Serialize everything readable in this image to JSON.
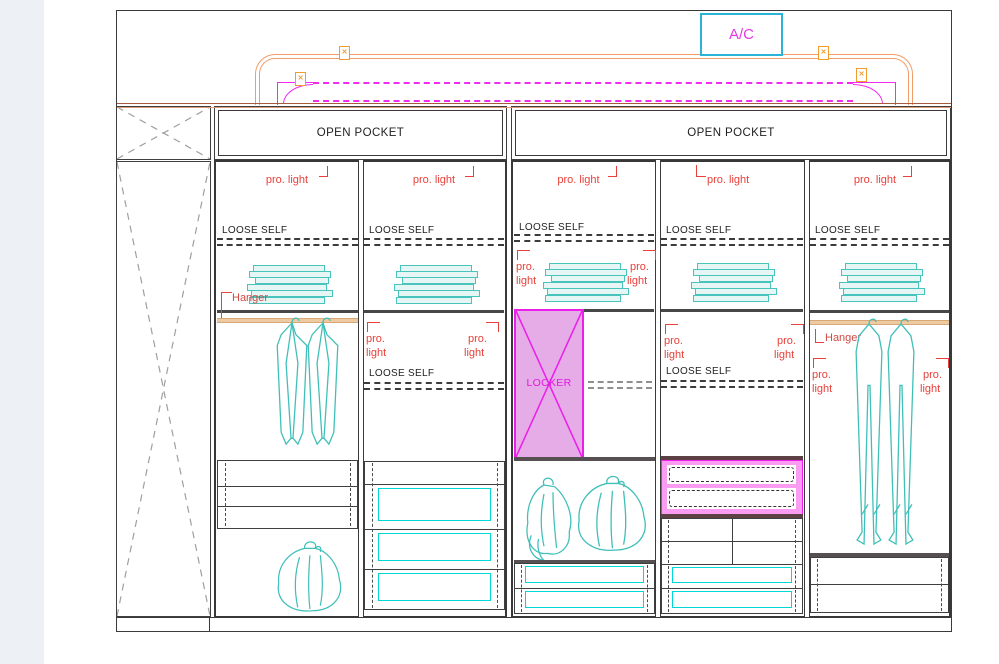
{
  "ac_unit": {
    "label": "A/C"
  },
  "open_pocket": {
    "left_label": "OPEN POCKET",
    "right_label": "OPEN POCKET"
  },
  "labels": {
    "pro_light": "pro. light",
    "pro": "pro.",
    "light": "light",
    "loose_shelf": "LOOSE SELF",
    "hanger": "Hanger",
    "locker": "LOCKER"
  },
  "icons": {
    "connector_x": "✕"
  },
  "colors": {
    "annotation_red": "#e8403a",
    "magenta": "#f21cf2",
    "locker_fill": "#e6ace7",
    "pink_drawer_fill": "#fb9cf3",
    "ac_border_cyan": "#2bb3d8",
    "garment_teal": "#3fbfb8",
    "drawer_front_cyan": "#00d8d8",
    "orange_route": "#ef9d6a",
    "wood_top": "#c98a64",
    "hanger_rod_tan": "#edcaa1",
    "viewer_sidebar": "#edf0f5"
  }
}
